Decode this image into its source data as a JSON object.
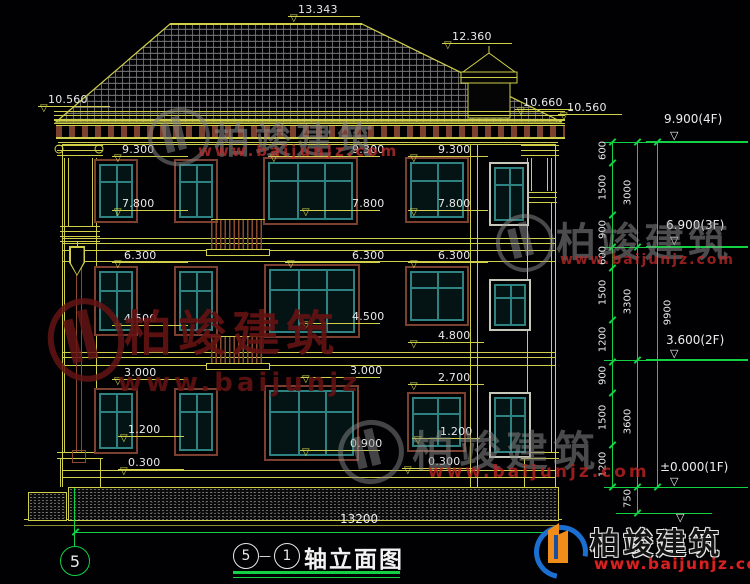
{
  "watermark": {
    "brand": "柏竣建筑",
    "url": "www.baijunjz.com",
    "url_short": "www.baijunjz"
  },
  "title_block": {
    "axis_start": "5",
    "axis_end": "1",
    "separator": "—",
    "name": "轴立面图"
  },
  "axis_bubble": "5",
  "overall_dim": "13200",
  "elevation_markers": [
    {
      "label": "13.343",
      "tx": 298,
      "ty": 3,
      "lx": 288,
      "ly": 16,
      "lw": 72
    },
    {
      "label": "12.360",
      "tx": 452,
      "ty": 30,
      "lx": 442,
      "ly": 43,
      "lw": 70
    },
    {
      "label": "10.560",
      "tx": 48,
      "ty": 93,
      "lx": 38,
      "ly": 106,
      "lw": 72
    },
    {
      "label": "10.660",
      "tx": 523,
      "ty": 96,
      "lx": 515,
      "ly": 109,
      "lw": 58
    },
    {
      "label": "10.560",
      "tx": 567,
      "ty": 101,
      "lx": 558,
      "ly": 114,
      "lw": 64
    },
    {
      "label": "9.300",
      "tx": 122,
      "ty": 143,
      "lx": 112,
      "ly": 156,
      "lw": 76
    },
    {
      "label": "9.300",
      "tx": 352,
      "ty": 143,
      "lx": 268,
      "ly": 156,
      "lw": 112
    },
    {
      "label": "9.300",
      "tx": 438,
      "ty": 143,
      "lx": 408,
      "ly": 156,
      "lw": 80
    },
    {
      "label": "7.800",
      "tx": 122,
      "ty": 197,
      "lx": 112,
      "ly": 210,
      "lw": 76
    },
    {
      "label": "7.800",
      "tx": 352,
      "ty": 197,
      "lx": 300,
      "ly": 210,
      "lw": 80
    },
    {
      "label": "7.800",
      "tx": 438,
      "ty": 197,
      "lx": 408,
      "ly": 210,
      "lw": 80
    },
    {
      "label": "6.300",
      "tx": 124,
      "ty": 249,
      "lx": 112,
      "ly": 262,
      "lw": 76
    },
    {
      "label": "6.300",
      "tx": 352,
      "ty": 249,
      "lx": 285,
      "ly": 262,
      "lw": 95
    },
    {
      "label": "6.300",
      "tx": 438,
      "ty": 249,
      "lx": 408,
      "ly": 262,
      "lw": 80
    },
    {
      "label": "4.500",
      "tx": 124,
      "ty": 312,
      "lx": 112,
      "ly": 325,
      "lw": 76
    },
    {
      "label": "4.500",
      "tx": 352,
      "ty": 310,
      "lx": 300,
      "ly": 323,
      "lw": 80
    },
    {
      "label": "4.800",
      "tx": 438,
      "ty": 329,
      "lx": 408,
      "ly": 342,
      "lw": 76
    },
    {
      "label": "3.000",
      "tx": 124,
      "ty": 366,
      "lx": 112,
      "ly": 379,
      "lw": 76
    },
    {
      "label": "3.000",
      "tx": 350,
      "ty": 364,
      "lx": 300,
      "ly": 377,
      "lw": 80
    },
    {
      "label": "2.700",
      "tx": 438,
      "ty": 371,
      "lx": 408,
      "ly": 384,
      "lw": 76
    },
    {
      "label": "1.200",
      "tx": 128,
      "ty": 423,
      "lx": 118,
      "ly": 436,
      "lw": 66
    },
    {
      "label": "1.200",
      "tx": 440,
      "ty": 425,
      "lx": 412,
      "ly": 438,
      "lw": 68
    },
    {
      "label": "0.900",
      "tx": 350,
      "ty": 437,
      "lx": 300,
      "ly": 450,
      "lw": 80
    },
    {
      "label": "0.300",
      "tx": 128,
      "ty": 456,
      "lx": 118,
      "ly": 469,
      "lw": 66
    },
    {
      "label": "0.300",
      "tx": 428,
      "ty": 455,
      "lx": 402,
      "ly": 468,
      "lw": 70
    }
  ],
  "floor_flags": [
    {
      "label": "9.900(4F)",
      "tx": 664,
      "ty": 112,
      "ly": 141
    },
    {
      "label": "6.900(3F)",
      "tx": 666,
      "ty": 218,
      "ly": 246
    },
    {
      "label": "3.600(2F)",
      "tx": 666,
      "ty": 333,
      "ly": 359
    },
    {
      "label": "±0.000(1F)",
      "tx": 660,
      "ty": 460,
      "ly": 487
    }
  ],
  "dim_chain": {
    "columns": [
      {
        "x": 612,
        "y1": 142,
        "y2": 487,
        "side": -1,
        "ticks": [
          142,
          163,
          215,
          247,
          268,
          320,
          362,
          393,
          445,
          487
        ],
        "labels": [
          {
            "t": "600",
            "y": 152
          },
          {
            "t": "1500",
            "y": 189
          },
          {
            "t": "900",
            "y": 231
          },
          {
            "t": "600",
            "y": 257
          },
          {
            "t": "1500",
            "y": 294
          },
          {
            "t": "1200",
            "y": 341
          },
          {
            "t": "900",
            "y": 377
          },
          {
            "t": "1500",
            "y": 419
          },
          {
            "t": "1200",
            "y": 466
          }
        ]
      },
      {
        "x": 637,
        "y1": 142,
        "y2": 513,
        "side": -1,
        "ticks": [
          142,
          247,
          360,
          487,
          513
        ],
        "labels": [
          {
            "t": "3000",
            "y": 194
          },
          {
            "t": "3300",
            "y": 303
          },
          {
            "t": "3600",
            "y": 423
          },
          {
            "t": "750",
            "y": 500
          }
        ]
      },
      {
        "x": 657,
        "y1": 142,
        "y2": 487,
        "side": 1,
        "ticks": [
          142,
          487
        ],
        "labels": [
          {
            "t": "9900",
            "y": 314
          }
        ]
      }
    ],
    "hlines": [
      {
        "y": 142,
        "x1": 604,
        "x2": 748
      },
      {
        "y": 247,
        "x1": 604,
        "x2": 748
      },
      {
        "y": 360,
        "x1": 604,
        "x2": 748
      },
      {
        "y": 487,
        "x1": 604,
        "x2": 748
      },
      {
        "y": 513,
        "x1": 616,
        "x2": 712
      }
    ]
  }
}
